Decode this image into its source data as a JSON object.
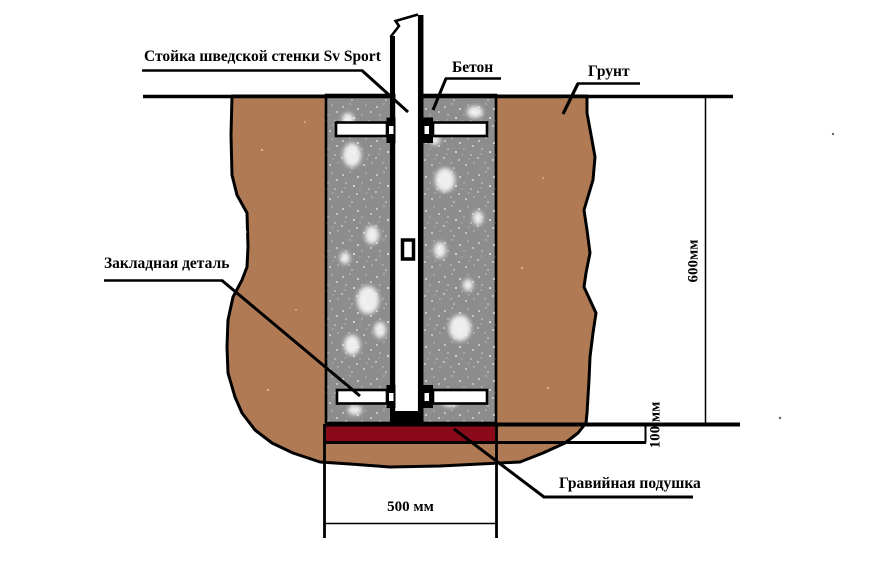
{
  "diagram": {
    "labels": {
      "post": "Стойка шведской стенки Sv Sport",
      "concrete": "Бетон",
      "ground": "Грунт",
      "embedded_part": "Закладная деталь",
      "gravel_pad": "Гравийная подушка"
    },
    "dimensions": {
      "depth": "600мм",
      "gravel_thickness": "100 мм",
      "pit_width": "500 мм"
    },
    "colors": {
      "ground": "#b07b54",
      "concrete": "#8d8d8d",
      "gravel": "#8b0a1a",
      "line": "#000000",
      "background": "#ffffff"
    }
  }
}
